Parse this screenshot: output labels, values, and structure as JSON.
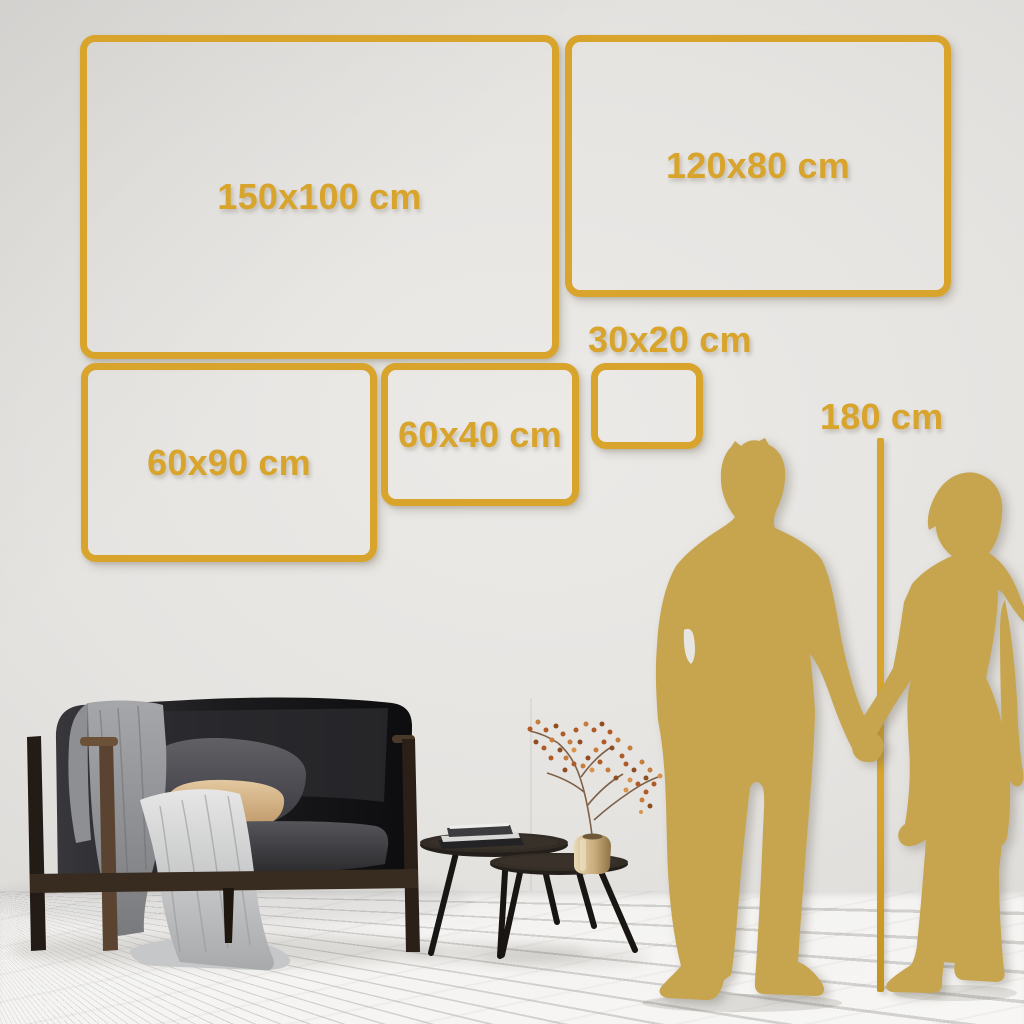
{
  "scene": {
    "frames": [
      {
        "id": "150x100",
        "label": "150x100 cm"
      },
      {
        "id": "120x80",
        "label": "120x80 cm"
      },
      {
        "id": "60x90",
        "label": "60x90 cm"
      },
      {
        "id": "60x40",
        "label": "60x40 cm"
      },
      {
        "id": "30x20",
        "label": "30x20 cm"
      }
    ],
    "ruler": {
      "label": "180 cm"
    }
  },
  "colors": {
    "gold": "#D8A42B",
    "silhouette": "#C7A54F",
    "wall": "#E4E2DF",
    "floor": "#F4F3F1"
  }
}
